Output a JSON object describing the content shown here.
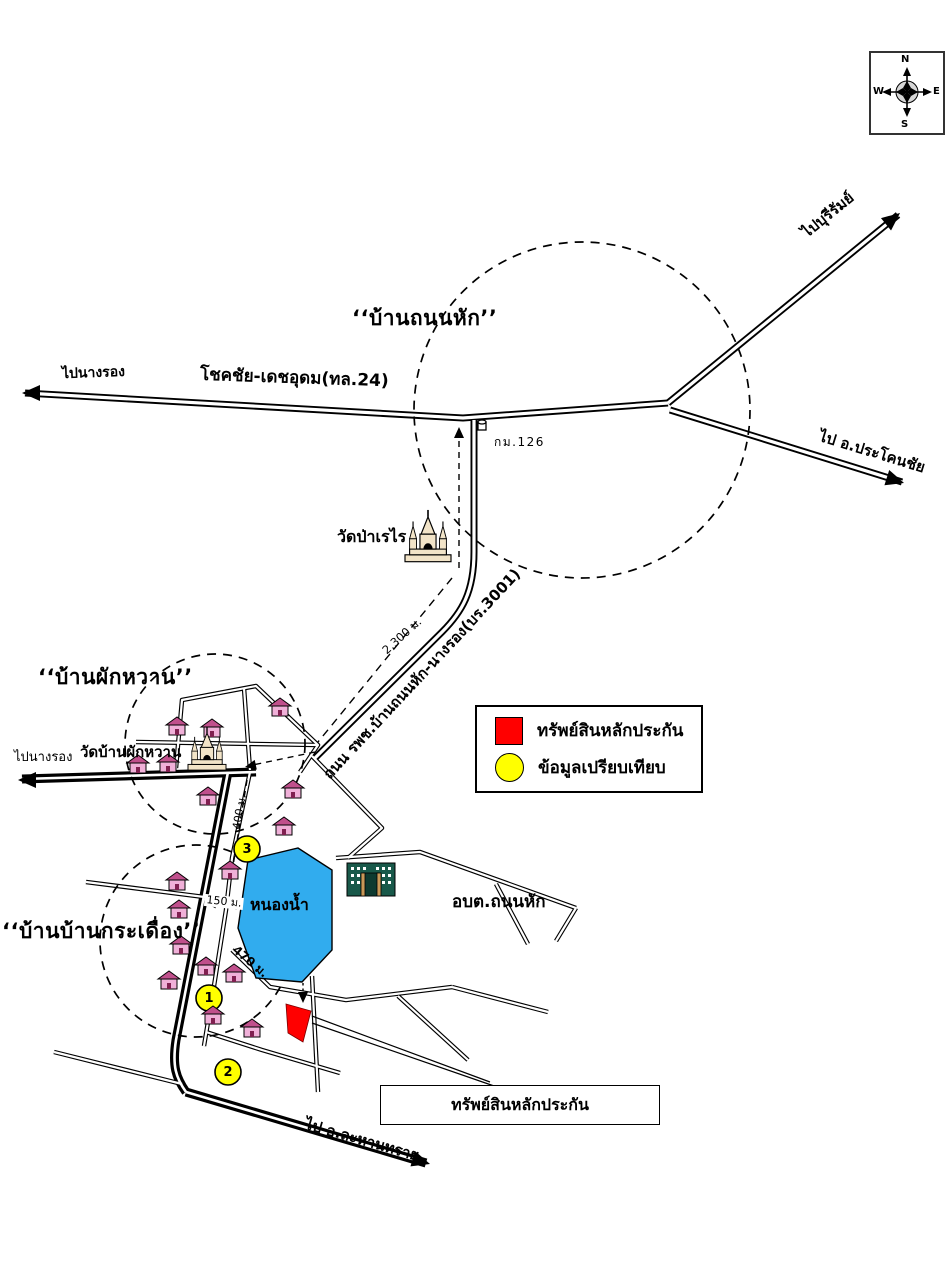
{
  "compass": {
    "n": "N",
    "s": "S",
    "e": "E",
    "w": "W"
  },
  "villages": [
    {
      "id": "ban-thanon-hak",
      "label": "‘‘บ้านถนนหัก’’"
    },
    {
      "id": "ban-phak-wan",
      "label": "‘‘บ้านผักหวาน’’"
    },
    {
      "id": "ban-ban-kradueang",
      "label": "‘‘บ้านบ้านกระเดื่อง’’"
    }
  ],
  "roads": {
    "highway24": "โชคชัย-เดชอุดม(ทล.24)",
    "to_nang_rong_top": "ไปนางรอง",
    "to_buriram": "ไปบุรีรัมย์",
    "to_prakhon_chai": "ไป อ.ประโคนชัย",
    "rphch_3001": "ถนน รพช.บ้านถนนหัก-นางรอง(บร.3001)",
    "to_nang_rong_left": "ไปนางรอง",
    "to_lahan_sai": "ไป อ.ละหานทราย"
  },
  "places": {
    "km_marker": "กม.126",
    "wat_pa_rerai": "วัดป่าเรไร",
    "wat_ban_phak_wan": "วัดบ้านผักหวาน",
    "pond": "หนองน้ำ",
    "obt": "อบต.ถนนหัก"
  },
  "distances": {
    "d2300": "2,300 ม.",
    "d400": "400 ม.",
    "d150": "150 ม.",
    "d470": "470 ม."
  },
  "legend": {
    "items": [
      {
        "symbol": "red-square",
        "color": "#FF0000",
        "label": "ทรัพย์สินหลักประกัน"
      },
      {
        "symbol": "yellow-circle",
        "color": "#FFFF00",
        "label": "ข้อมูลเปรียบเทียบ"
      }
    ]
  },
  "callout": {
    "label": "ทรัพย์สินหลักประกัน"
  },
  "comparables": [
    {
      "n": "1"
    },
    {
      "n": "2"
    },
    {
      "n": "3"
    }
  ],
  "colors": {
    "pond": "#31ACEE",
    "collateral": "#FF0000",
    "comparable": "#FFFF00",
    "house_body": "#F0B0D8",
    "house_roof": "#C0508C",
    "obt_building": "#19594A"
  }
}
